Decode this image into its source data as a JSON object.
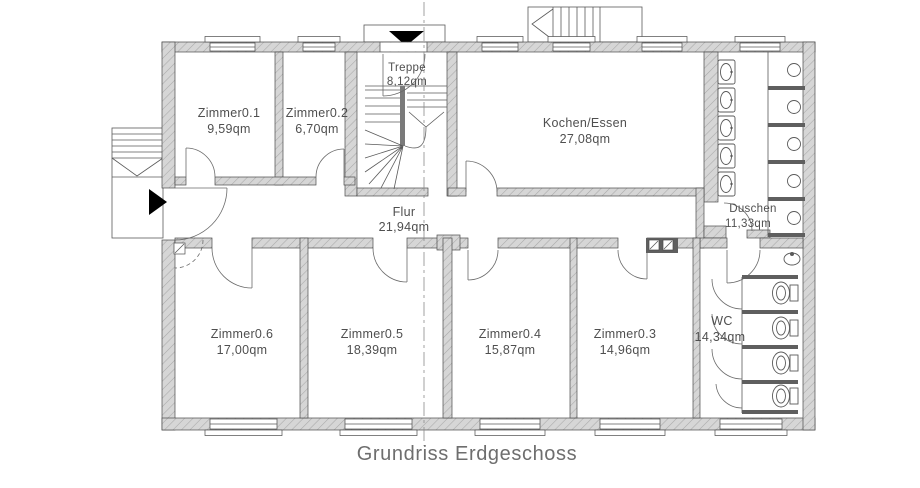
{
  "caption": "Grundriss Erdgeschoss",
  "rooms": [
    {
      "name": "Zimmer0.1",
      "area": "9,59qm"
    },
    {
      "name": "Zimmer0.2",
      "area": "6,70qm"
    },
    {
      "name": "Treppe",
      "area": "8,12qm"
    },
    {
      "name": "Kochen/Essen",
      "area": "27,08qm"
    },
    {
      "name": "Duschen",
      "area": "11,33qm"
    },
    {
      "name": "Flur",
      "area": "21,94qm"
    },
    {
      "name": "Zimmer0.6",
      "area": "17,00qm"
    },
    {
      "name": "Zimmer0.5",
      "area": "18,39qm"
    },
    {
      "name": "Zimmer0.4",
      "area": "15,87qm"
    },
    {
      "name": "Zimmer0.3",
      "area": "14,96qm"
    },
    {
      "name": "WC",
      "area": "14,34qm"
    }
  ],
  "fixtures": {
    "washbasins": 5,
    "shower_stalls": 5,
    "toilet_stalls": 4
  },
  "colors": {
    "wall_fill": "#d6d6d6",
    "wall_hatch": "#a8a8a8",
    "outline": "#4a4a4a",
    "label_text": "#4f4f4f",
    "caption_text": "#6e6e6e",
    "entrance_marker": "#000000"
  }
}
